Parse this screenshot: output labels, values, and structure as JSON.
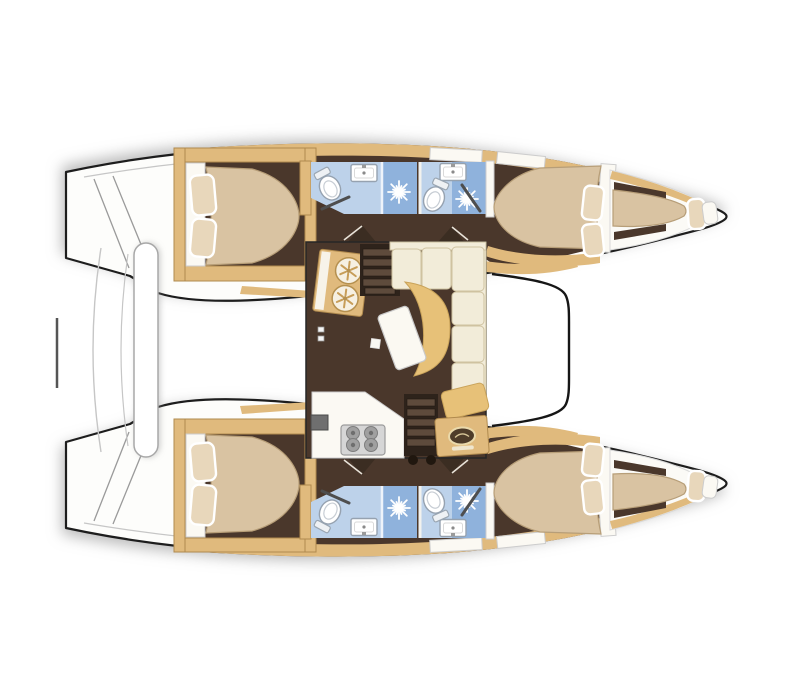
{
  "palette": {
    "white_soft": "#fdfdfb",
    "outline_black": "#1d1d1d",
    "line_gray": "#c6c6c6",
    "shadow_gray": "rgba(120,120,120,0.5)",
    "floor_brown": "#4a372b",
    "trim_tan": "#e0ba7d",
    "trim_stroke": "#b08a4e",
    "bed_tan": "#d9c3a2",
    "bed_stroke": "#b79e78",
    "pillow_beige": "#e8d7bb",
    "cream": "#f2ecd9",
    "cream_stroke": "#cfc2a0",
    "table_tan": "#e7c178",
    "table_stroke": "#c9a35a",
    "bath_light": "#bdd2ea",
    "bath_mid": "#8fb2dc",
    "stair_dark": "#2e231b",
    "stair_step": "#5e4b3c",
    "stove_gray": "#d6d6d6",
    "burner_gray": "#a0a0a0",
    "logo_brown": "#4e3c2a"
  },
  "plan": {
    "vessel": "catamaran",
    "view": "overhead-interior-layout",
    "hulls": [
      {
        "id": "port-hull",
        "rooms": [
          {
            "name": "aft-cabin",
            "features": [
              "double-berth",
              "two-pillows"
            ]
          },
          {
            "name": "aft-head",
            "features": [
              "toilet",
              "sink",
              "shower-stall"
            ]
          },
          {
            "name": "forward-head",
            "features": [
              "toilet",
              "sink",
              "shower-stall"
            ]
          },
          {
            "name": "forward-cabin",
            "features": [
              "double-berth",
              "two-pillows"
            ]
          },
          {
            "name": "forepeak",
            "features": [
              "single-berth",
              "pillow"
            ]
          },
          {
            "name": "transom",
            "features": [
              "boarding-steps"
            ]
          }
        ]
      },
      {
        "id": "starboard-hull",
        "rooms": [
          {
            "name": "aft-cabin",
            "features": [
              "double-berth",
              "two-pillows"
            ]
          },
          {
            "name": "aft-head",
            "features": [
              "toilet",
              "sink",
              "shower-stall"
            ]
          },
          {
            "name": "forward-head",
            "features": [
              "toilet",
              "sink",
              "shower-stall"
            ]
          },
          {
            "name": "forward-cabin",
            "features": [
              "double-berth",
              "two-pillows"
            ]
          },
          {
            "name": "forepeak",
            "features": [
              "single-berth",
              "pillow"
            ]
          },
          {
            "name": "transom",
            "features": [
              "boarding-steps"
            ]
          }
        ]
      }
    ],
    "saloon": {
      "features": [
        "galley-sink-unit",
        "companionway-stairs-port",
        "l-shaped-settee",
        "dining-table",
        "chaise-cushion",
        "galley-counter",
        "four-burner-stove",
        "companionway-stairs-starboard",
        "fridge-unit-with-brand-badge",
        "sliding-door-handles"
      ]
    },
    "between_hulls": [
      "aft-bench",
      "davit-bar",
      "forward-crossbeam"
    ]
  }
}
